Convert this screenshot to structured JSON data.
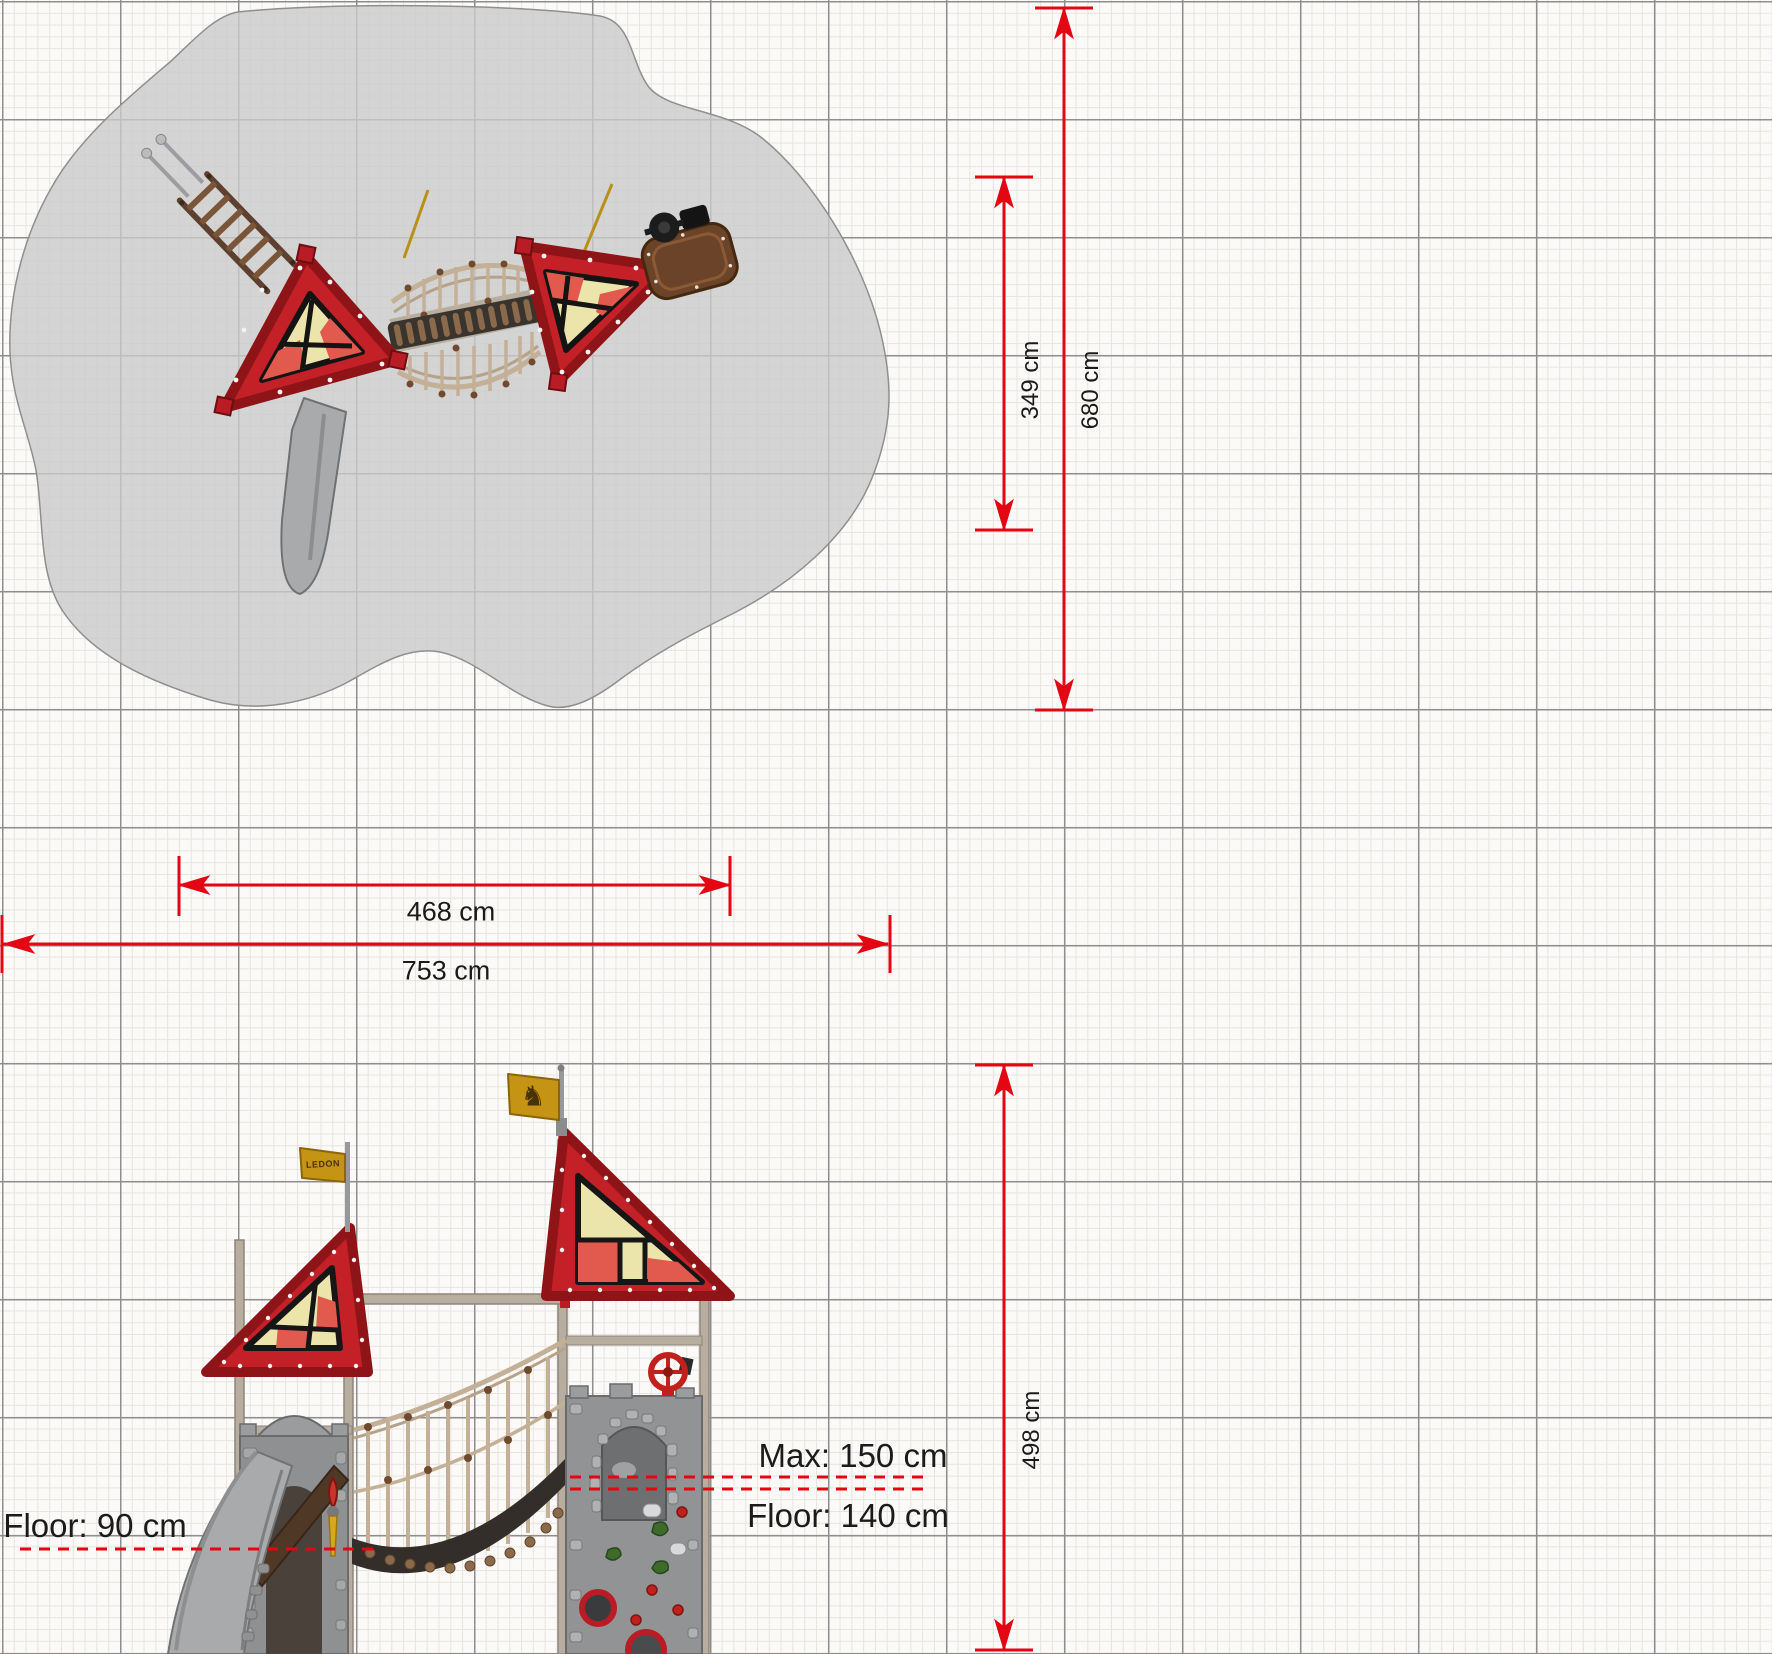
{
  "drawing": {
    "title": "Playground equipment dimension drawing",
    "views": {
      "plan": "top view with safety zone",
      "elevation": "side view"
    }
  },
  "dims": {
    "d349": "349 cm",
    "d680": "680 cm",
    "d468": "468 cm",
    "d753": "753 cm",
    "d498": "498 cm"
  },
  "annotations": {
    "max_height": "Max: 150 cm",
    "floor_right": "Floor: 140 cm",
    "floor_left": "Floor: 90 cm"
  },
  "flags": {
    "left_label": "LEDON",
    "right_emblem": "♞"
  },
  "colors": {
    "dimension_red": "#e30613",
    "roof_red": "#c32127",
    "roof_edge": "#8e1418",
    "pane_cream": "#ece5ab",
    "pane_red": "#e25a4e",
    "flag_gold": "#c59414",
    "post_beige": "#b7aea0",
    "panel_gray": "#929395",
    "slide_gray": "#a8aaac",
    "wood_brown": "#5d4030",
    "rope_tan": "#c4b096",
    "knot_brown": "#6f4a2e",
    "safety_zone": "#cbcbcb",
    "grid_major": "#8e8e8e",
    "grid_fine": "#e7e4de"
  }
}
